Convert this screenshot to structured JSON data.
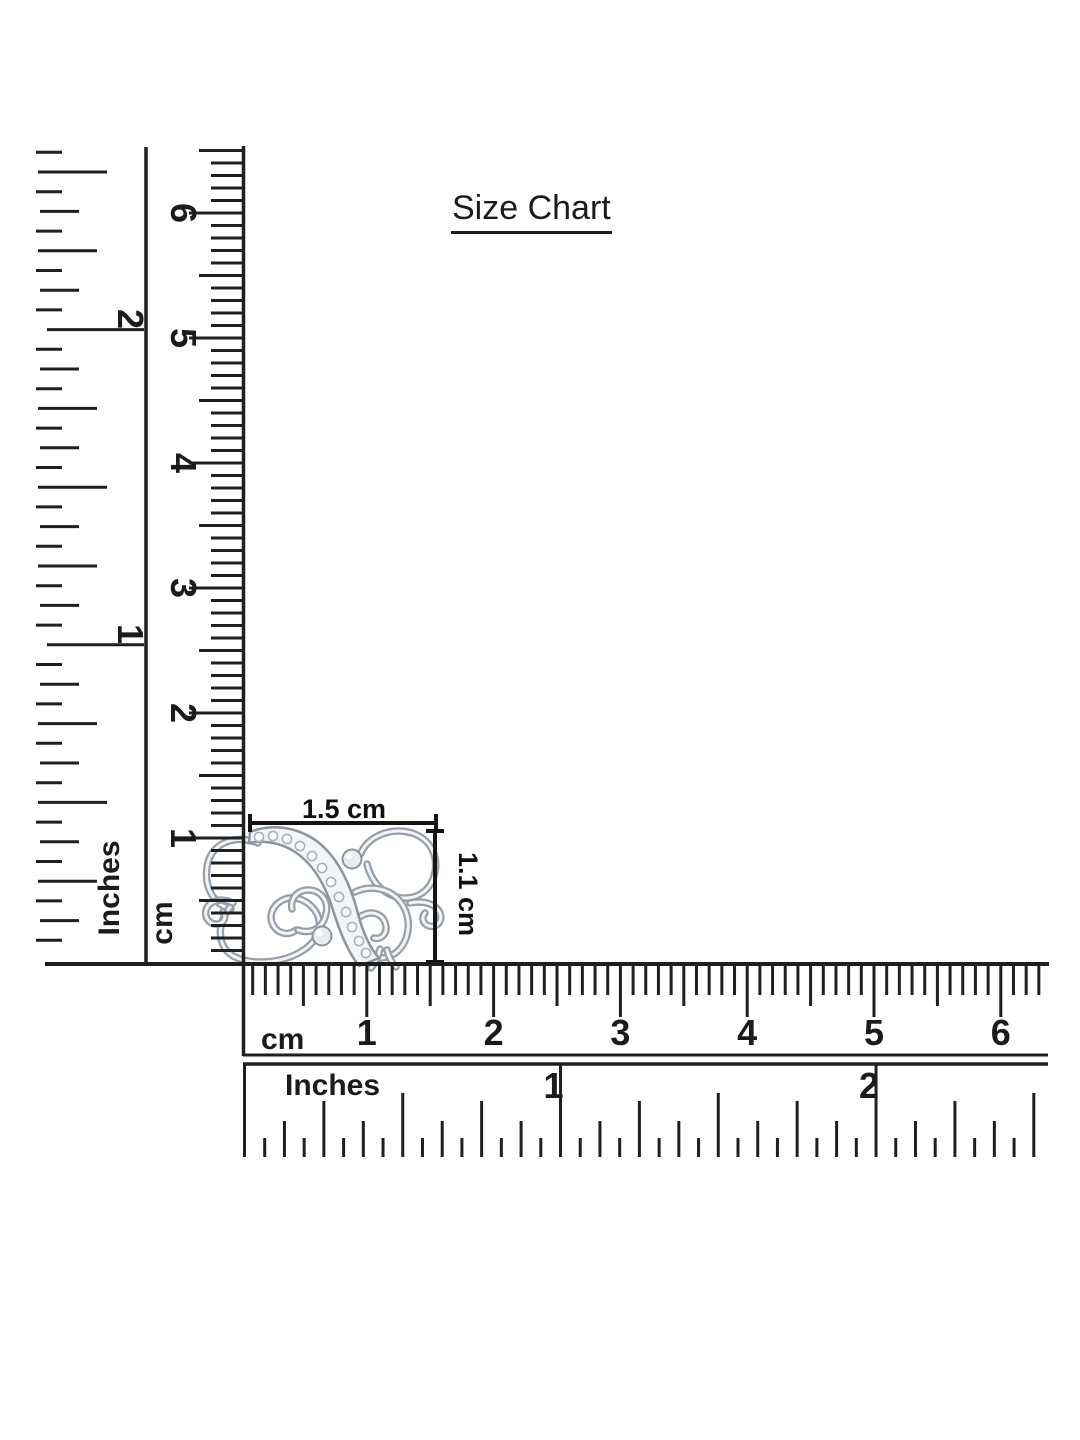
{
  "title": {
    "text": "Size Chart"
  },
  "item": {
    "description": "silver butterfly jewelry piece with pave stone band",
    "width_label": "1.5 cm",
    "height_label": "1.1 cm"
  },
  "rulers": {
    "left_inches": {
      "unit_label": "Inches",
      "numbers": [
        1,
        2
      ]
    },
    "left_cm": {
      "unit_label": "cm",
      "numbers": [
        1,
        2,
        3,
        4,
        5,
        6
      ]
    },
    "bottom_cm": {
      "unit_label": "cm",
      "numbers": [
        1,
        2,
        3,
        4,
        5,
        6
      ]
    },
    "bottom_inches": {
      "unit_label": "Inches",
      "numbers": [
        1,
        2
      ]
    }
  },
  "colors": {
    "ink": "#1f1f1f",
    "background": "#ffffff",
    "metal_outline": "#8d959c",
    "metal_fill": "#f2f4f6",
    "metal_mid": "#c8cdd2",
    "stone_stroke": "#aab2b9"
  }
}
